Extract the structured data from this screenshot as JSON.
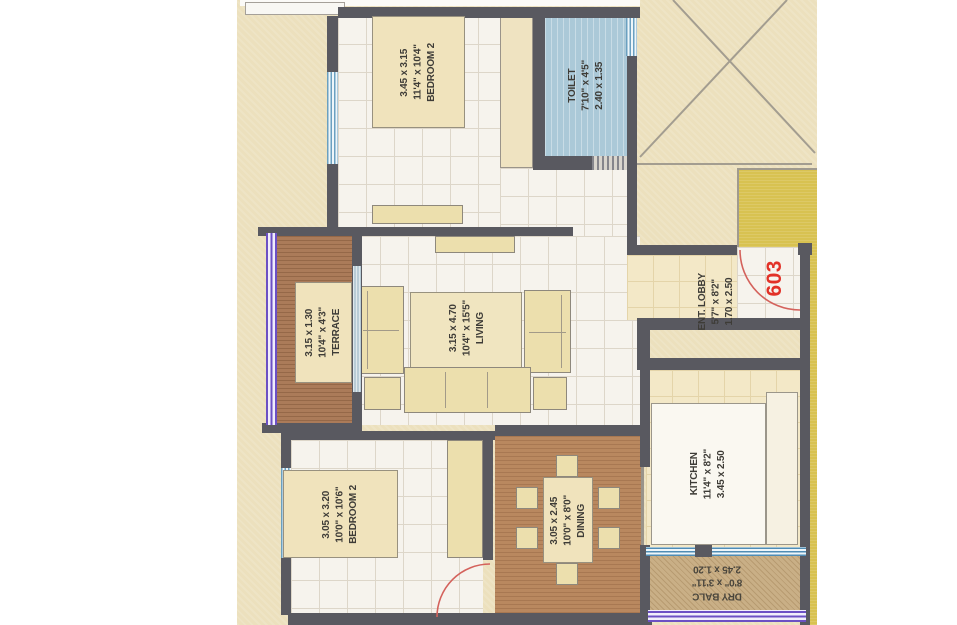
{
  "unit_number": "603",
  "rooms": {
    "bedroom2_top": {
      "name": "BEDROOM 2",
      "metric": "3.45 x 3.15",
      "imperial": "11'4\" x 10'4\""
    },
    "toilet": {
      "name": "TOILET",
      "metric": "2.40 x 1.35",
      "imperial": "7'10\" x 4'5\""
    },
    "terrace": {
      "name": "TERRACE",
      "metric": "3.15 x 1.30",
      "imperial": "10'4\" x 4'3\""
    },
    "living": {
      "name": "LIVING",
      "metric": "3.15 x 4.70",
      "imperial": "10'4\" x 15'5\""
    },
    "ent_lobby": {
      "name": "ENT. LOBBY",
      "metric": "1.70 x 2.50",
      "imperial": "5'7\" x 8'2\""
    },
    "kitchen": {
      "name": "KITCHEN",
      "metric": "3.45 x 2.50",
      "imperial": "11'4\" x 8'2\""
    },
    "bedroom2_bottom": {
      "name": "BEDROOM 2",
      "metric": "3.05 x 3.20",
      "imperial": "10'0\" x 10'6\""
    },
    "dining": {
      "name": "DINING",
      "metric": "3.05 x 2.45",
      "imperial": "10'0\" x 8'0\""
    },
    "dry_balcony": {
      "name": "DRY BALC",
      "metric": "2.45 x 1.20",
      "imperial": "8'0\" x 3'11\""
    }
  },
  "colors": {
    "unit_number_red": "#e23127",
    "lift_block_yellow": "#d8c251",
    "toilet_blue": "#abc9d8",
    "terrace_brown": "#ab7b59",
    "dining_brown": "#b9885f",
    "dry_balcony_tan": "#c9af86",
    "wall_gray": "#595960",
    "window_purple": "#6c50c4",
    "window_blue": "#5f9cc0",
    "door_arc_red": "#d4625c"
  }
}
